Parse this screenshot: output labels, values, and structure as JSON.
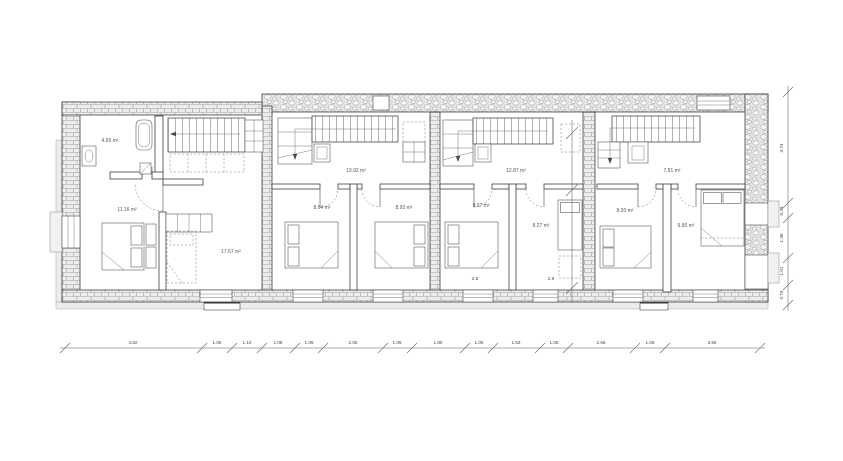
{
  "floor_plan": {
    "units": [
      {
        "id": "unit-1",
        "room_areas": [
          "4.65 m²",
          "11.16 m²",
          "17.67 m²"
        ]
      },
      {
        "id": "unit-2",
        "room_areas": [
          "13.92 m²",
          "8.64 m²",
          "8.92 m²"
        ]
      },
      {
        "id": "unit-3",
        "room_areas": [
          "12.87 m²",
          "9.07 m²",
          "8.27 m²"
        ]
      },
      {
        "id": "unit-4",
        "room_areas": [
          "7.91 m²",
          "8.20 m²",
          "9.90 m²"
        ]
      }
    ],
    "dimensions": {
      "bottom_chain": [
        "4.62",
        "1.06",
        "1.10",
        "1.08",
        "1.06",
        "2.05",
        "1.06",
        "1.80",
        "1.05",
        "1.53",
        "1.05",
        "2.56",
        "1.06",
        "3.56"
      ],
      "right_chain": [
        "3.74",
        "0.48",
        "1.36",
        "1.01",
        "0.74"
      ],
      "internal": [
        "2.8",
        "2.8"
      ]
    },
    "colors": {
      "line": "#4a4a4a",
      "wall_fill": "#ededed",
      "hatch_line": "#9f9f9f",
      "background": "#ffffff"
    }
  }
}
